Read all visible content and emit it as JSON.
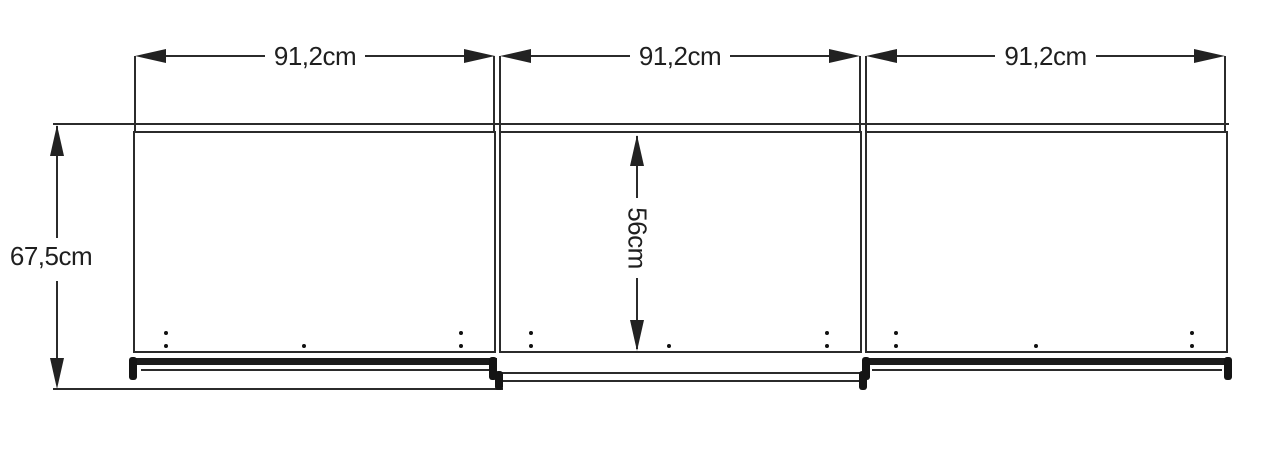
{
  "diagram": {
    "type": "sliding-door wardrobe dimension drawing",
    "unit": "cm",
    "top_dimensions": [
      {
        "label": "91,2cm",
        "value_cm": 91.2
      },
      {
        "label": "91,2cm",
        "value_cm": 91.2
      },
      {
        "label": "91,2cm",
        "value_cm": 91.2
      }
    ],
    "left_dimension": {
      "label": "67,5cm",
      "value_cm": 67.5
    },
    "center_dimension": {
      "label": "56cm",
      "value_cm": 56
    },
    "colors": {
      "line": "#2b2b2b",
      "background": "#ffffff",
      "text": "#1f1f1f"
    }
  }
}
